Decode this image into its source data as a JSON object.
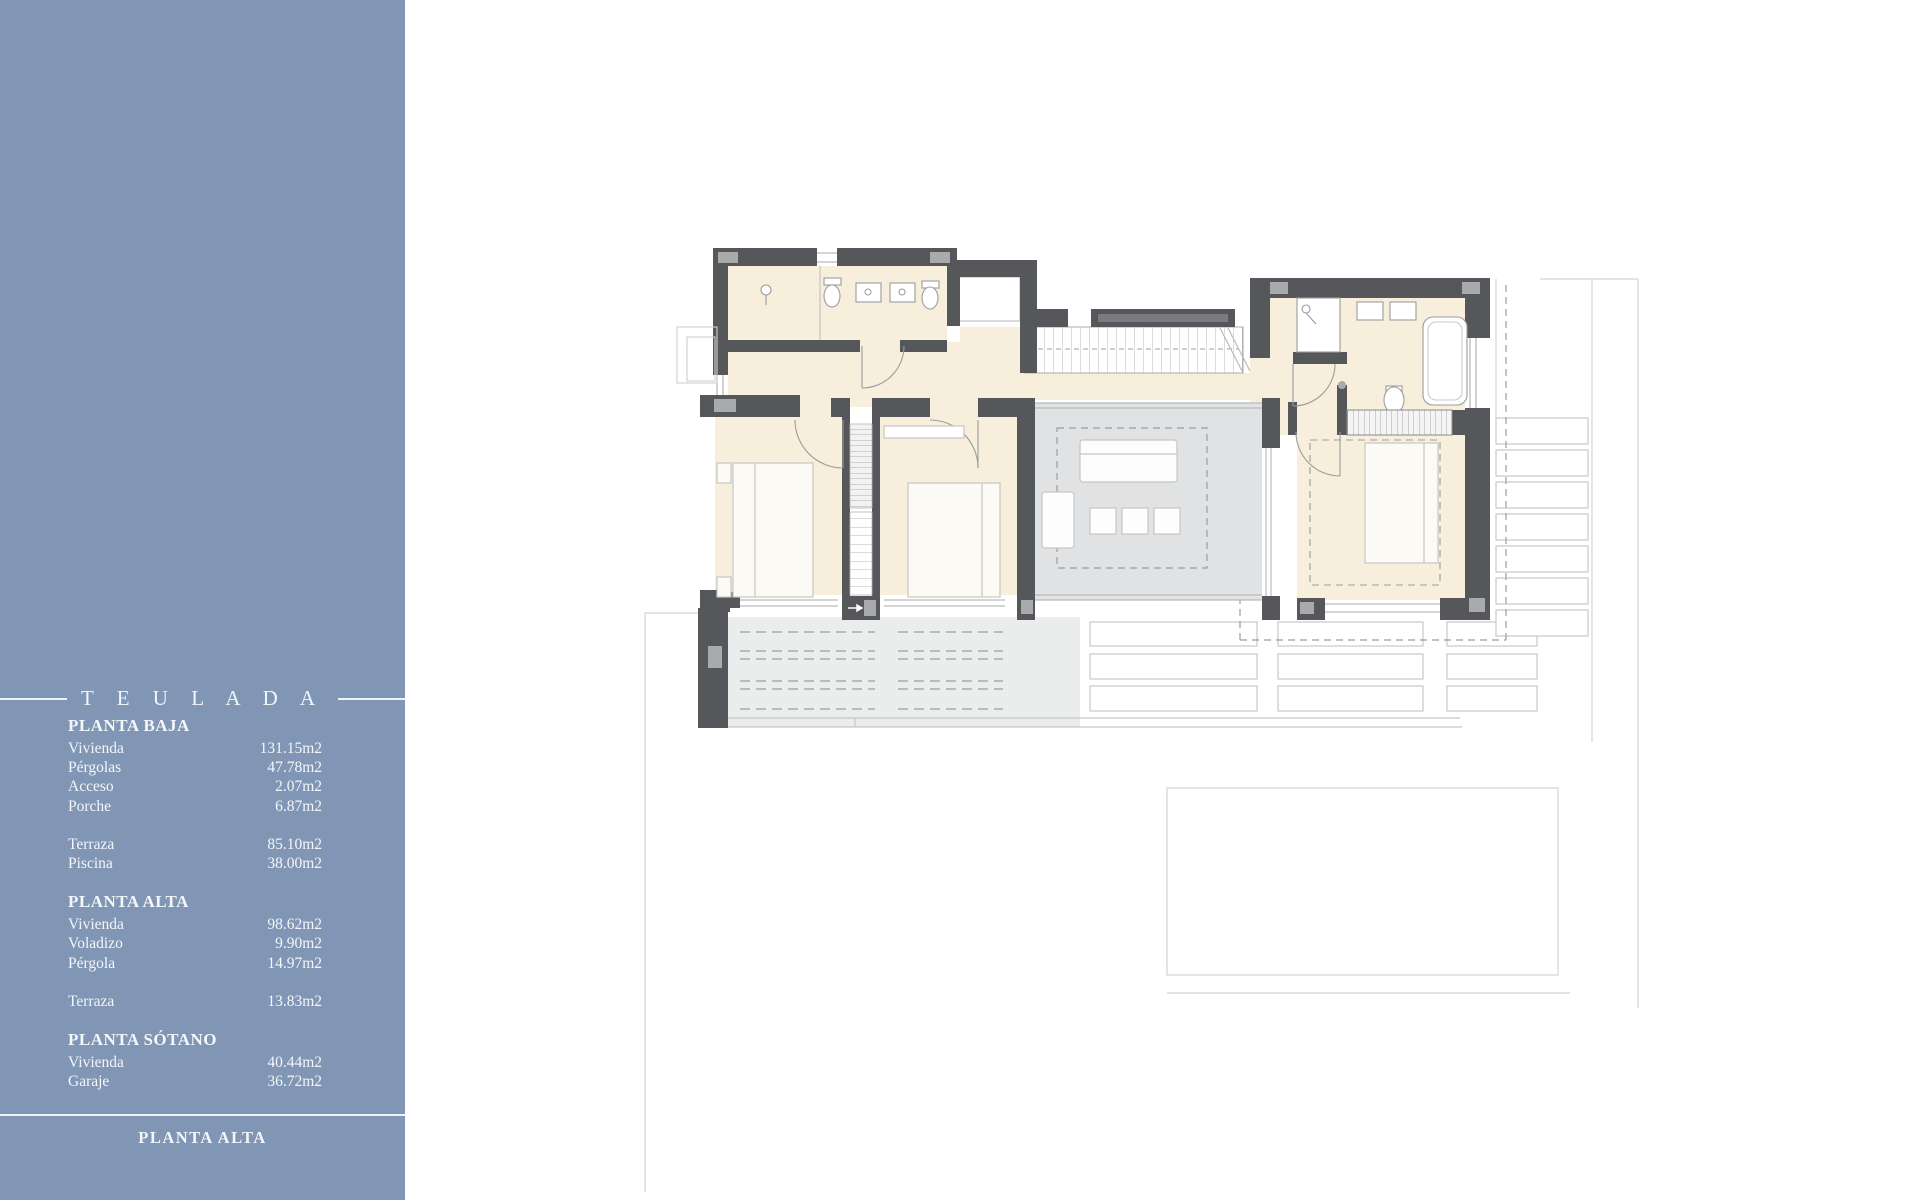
{
  "sidebar": {
    "title": "T E U L A D A",
    "footer": "PLANTA ALTA",
    "sections": [
      {
        "heading": "PLANTA BAJA",
        "groups": [
          [
            {
              "label": "Vivienda",
              "value": "131.15m2"
            },
            {
              "label": "Pérgolas",
              "value": "47.78m2"
            },
            {
              "label": "Acceso",
              "value": "2.07m2"
            },
            {
              "label": "Porche",
              "value": "6.87m2"
            }
          ],
          [
            {
              "label": "Terraza",
              "value": "85.10m2"
            },
            {
              "label": "Piscina",
              "value": "38.00m2"
            }
          ]
        ]
      },
      {
        "heading": "PLANTA ALTA",
        "groups": [
          [
            {
              "label": "Vivienda",
              "value": "98.62m2"
            },
            {
              "label": "Voladizo",
              "value": "9.90m2"
            },
            {
              "label": "Pérgola",
              "value": "14.97m2"
            }
          ],
          [
            {
              "label": "Terraza",
              "value": "13.83m2"
            }
          ]
        ]
      },
      {
        "heading": "PLANTA SÓTANO",
        "groups": [
          [
            {
              "label": "Vivienda",
              "value": "40.44m2"
            },
            {
              "label": "Garaje",
              "value": "36.72m2"
            }
          ]
        ]
      }
    ]
  },
  "plan": {
    "colors": {
      "sidebar_blue": "#8096B4",
      "wall_dark": "#56575B",
      "floor_cream": "#F7EFDC",
      "void_gray": "#E0E2E3",
      "terrace_gray": "#EBECEC",
      "faint_line": "#DCDCDC"
    }
  }
}
